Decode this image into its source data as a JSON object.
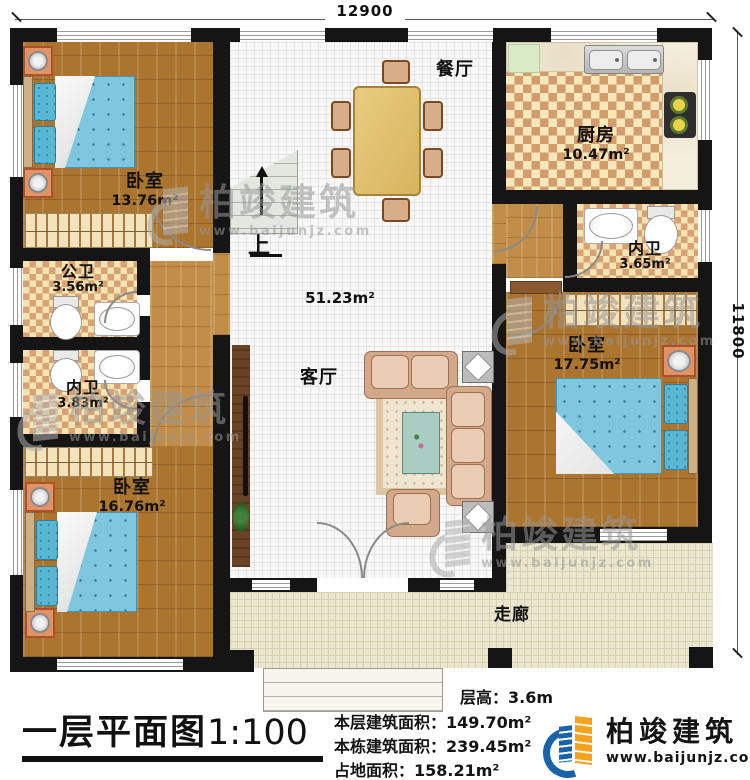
{
  "plan": {
    "dimensions": {
      "top": "12900",
      "right": "11800"
    },
    "stairs_label": "上",
    "rooms": [
      {
        "id": "bedroom-top-left",
        "label": "卧室",
        "area": "13.76m²"
      },
      {
        "id": "dining",
        "label": "餐厅",
        "area": ""
      },
      {
        "id": "kitchen",
        "label": "厨房",
        "area": "10.47m²"
      },
      {
        "id": "bath-inner-right",
        "label": "内卫",
        "area": "3.65m²"
      },
      {
        "id": "bedroom-right",
        "label": "卧室",
        "area": "17.75m²"
      },
      {
        "id": "bath-public",
        "label": "公卫",
        "area": "3.56m²"
      },
      {
        "id": "bath-inner-left",
        "label": "内卫",
        "area": "3.83m²"
      },
      {
        "id": "living",
        "label": "客厅",
        "area": "51.23m²"
      },
      {
        "id": "bedroom-bottom-left",
        "label": "卧室",
        "area": "16.76m²"
      },
      {
        "id": "corridor",
        "label": "走廊",
        "area": ""
      }
    ]
  },
  "title": {
    "text": "一层平面图",
    "scale": "1:100"
  },
  "stats": {
    "floor_height": {
      "label": "层高：",
      "value": "3.6m"
    },
    "rows": [
      {
        "label": "本层建筑面积：",
        "value": "149.70m²"
      },
      {
        "label": "本栋建筑面积：",
        "value": "239.45m²"
      },
      {
        "label": "占地面积：",
        "value": "158.21m²"
      }
    ]
  },
  "brand": {
    "name": "柏竣建筑",
    "site": "www.baijunjz.com"
  },
  "watermark": {
    "name": "柏竣建筑",
    "site": "www.baijunjz.com"
  },
  "colors": {
    "wall": "#151515",
    "wood_floor": "#ab742f",
    "checker_dark": "#d29c6b",
    "checker_light": "#f6e8bb",
    "bed_blue": "#7ec7de",
    "corridor_tile": "#eae6cf",
    "brand_blue": "#1b63a8",
    "brand_orange": "#f6a21d"
  }
}
